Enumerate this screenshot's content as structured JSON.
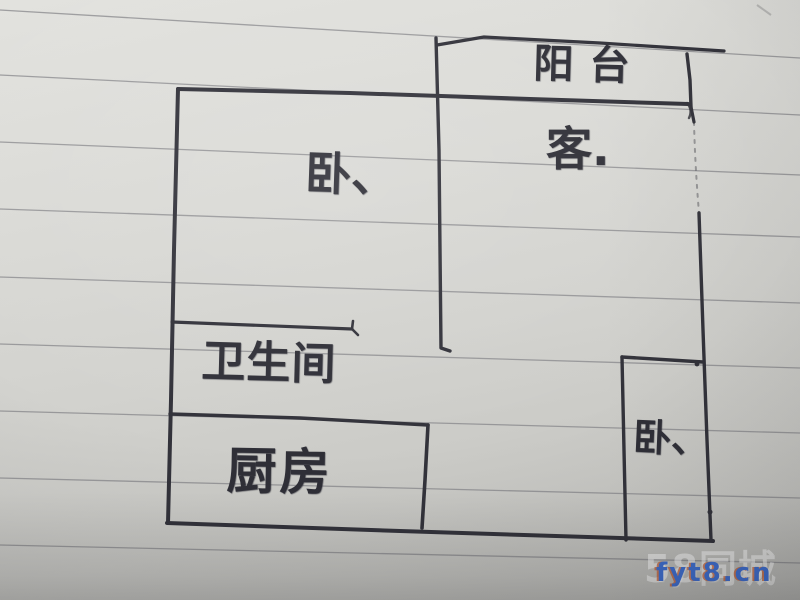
{
  "rooms": {
    "balcony": {
      "label": "阳台"
    },
    "living": {
      "label": "客."
    },
    "bedroom_main": {
      "label": "卧、"
    },
    "bathroom": {
      "label": "卫生间"
    },
    "kitchen": {
      "label": "厨房"
    },
    "bedroom_small": {
      "label": "卧、"
    }
  },
  "watermark": {
    "logo": "58同城",
    "site": "fyt8.cn",
    "site_color": "#3f6fd2",
    "logo_color": "#ffffff"
  },
  "colors": {
    "ink": "#32323a",
    "paper": "#d6d6d2",
    "ruled_line": "#85858a"
  }
}
